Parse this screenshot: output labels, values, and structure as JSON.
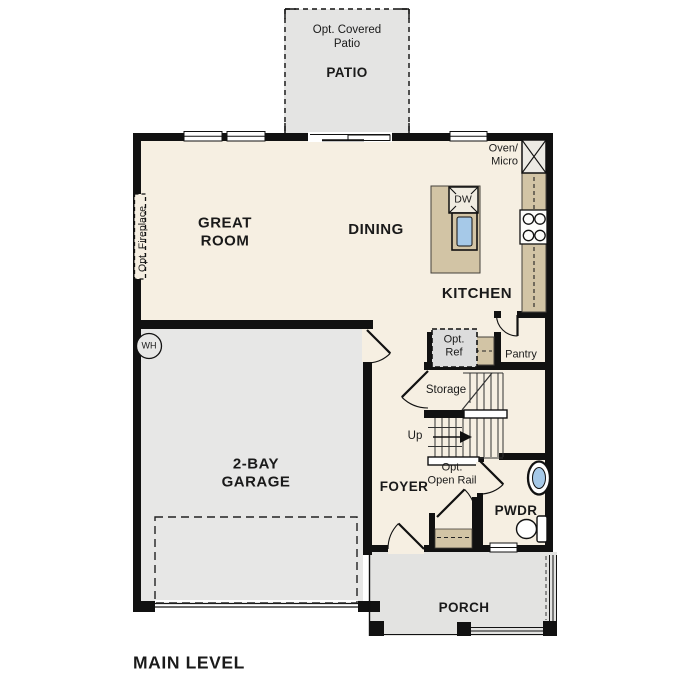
{
  "title": "MAIN LEVEL",
  "colors": {
    "walls": "#111111",
    "floor_cream": "#f6efe2",
    "garage_gray": "#e7e7e6",
    "patio_gray": "#e4e4e3",
    "porch_gray": "#e3e3e1",
    "counter_tan": "#d2c4a5",
    "fixture_blue": "#a6c9e8"
  },
  "patio": {
    "note": "Opt. Covered\nPatio",
    "name": "PATIO"
  },
  "rooms": {
    "great_room": "GREAT\nROOM",
    "dining": "DINING",
    "kitchen": "KITCHEN",
    "pantry": "Pantry",
    "storage": "Storage",
    "foyer": "FOYER",
    "pwdr": "PWDR",
    "garage": "2-BAY\nGARAGE",
    "porch": "PORCH"
  },
  "annotations": {
    "oven_micro": "Oven/\nMicro",
    "dw": "DW",
    "opt_ref": "Opt.\nRef",
    "up": "Up",
    "opt_open_rail": "Opt.\nOpen Rail",
    "opt_fireplace": "Opt. Fireplace",
    "wh": "WH"
  }
}
